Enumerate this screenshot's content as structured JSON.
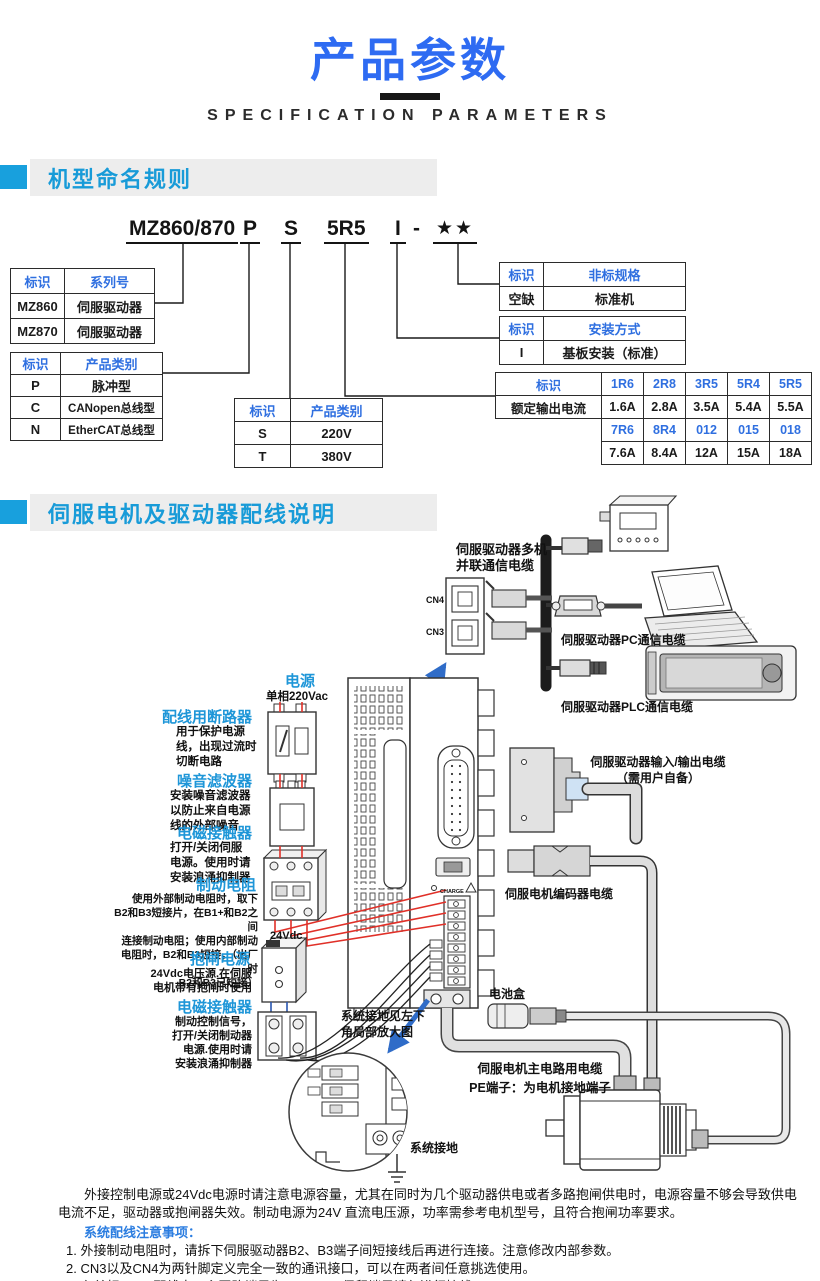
{
  "header": {
    "title": "产品参数",
    "subtitle": "SPECIFICATION PARAMETERS"
  },
  "naming": {
    "heading": "机型命名规则",
    "code": {
      "series": "MZ860/870",
      "product_type": "P",
      "voltage": "S",
      "current": "5R5",
      "mounting": "I",
      "separator": "-",
      "stars": "★★"
    },
    "series_table": {
      "headers": [
        "标识",
        "系列号"
      ],
      "rows": [
        [
          "MZ860",
          "伺服驱动器"
        ],
        [
          "MZ870",
          "伺服驱动器"
        ]
      ]
    },
    "product_type_table": {
      "headers": [
        "标识",
        "产品类别"
      ],
      "rows": [
        [
          "P",
          "脉冲型"
        ],
        [
          "C",
          "CANopen总线型"
        ],
        [
          "N",
          "EtherCAT总线型"
        ]
      ]
    },
    "voltage_table": {
      "headers": [
        "标识",
        "产品类别"
      ],
      "rows": [
        [
          "S",
          "220V"
        ],
        [
          "T",
          "380V"
        ]
      ]
    },
    "nonstandard_table": {
      "headers": [
        "标识",
        "非标规格"
      ],
      "rows": [
        [
          "空缺",
          "标准机"
        ]
      ]
    },
    "mounting_table": {
      "headers": [
        "标识",
        "安装方式"
      ],
      "rows": [
        [
          "I",
          "基板安装（标准）"
        ]
      ]
    },
    "current_table": {
      "header_label": "标识",
      "row_label": "额定输出电流",
      "codes_top": [
        "1R6",
        "2R8",
        "3R5",
        "5R4",
        "5R5"
      ],
      "amps_top": [
        "1.6A",
        "2.8A",
        "3.5A",
        "5.4A",
        "5.5A"
      ],
      "codes_bottom": [
        "7R6",
        "8R4",
        "012",
        "015",
        "018"
      ],
      "amps_bottom": [
        "7.6A",
        "8.4A",
        "12A",
        "15A",
        "18A"
      ]
    }
  },
  "wiring": {
    "heading": "伺服电机及驱动器配线说明",
    "power": {
      "title": "电源",
      "sub": "单相220Vac"
    },
    "breaker": {
      "title": "配线用断路器",
      "desc": "用于保护电源\n线，出现过流时\n切断电路"
    },
    "filter": {
      "title": "噪音滤波器",
      "desc": "安装噪音滤波器\n以防止来自电源\n线的外部噪音"
    },
    "contactor1": {
      "title": "电磁接触器",
      "desc": "打开/关闭伺服\n电源。使用时请\n安装浪涌抑制器"
    },
    "brake_resistor": {
      "title": "制动电阻",
      "desc": "使用外部制动电阻时，取下\nB2和B3短接片，在B1+和B2之间\n连接制动电阻；使用内部制动\n电阻时，B2和B3短接，（出厂时\nB2和B3已短接）"
    },
    "psu_24v": {
      "tag": "24Vdc",
      "title": "抱闸电源",
      "desc": "24Vdc电压源.在伺服\n电机带有抱闸时使用"
    },
    "contactor2": {
      "title": "电磁接触器",
      "desc": "制动控制信号，\n打开/关闭制动器\n电源.使用时请\n安装浪涌抑制器"
    },
    "multi_comm": "伺服驱动器多机\n并联通信电缆",
    "cn4": "CN4",
    "cn3": "CN3",
    "pc_cable": "伺服驱动器PC通信电缆",
    "plc_cable": "伺服驱动器PLC通信电缆",
    "io_cable": "伺服驱动器输入/输出电缆\n（需用户自备）",
    "encoder_cable": "伺服电机编码器电缆",
    "battery": "电池盒",
    "ground_note": "系统接地见左下\n角局部放大图",
    "motor_cable": "伺服电机主电路用电缆\nPE端子：为电机接地端子",
    "system_ground": "系统接地",
    "charge": "CHARGE"
  },
  "notes": {
    "paragraph": "外接控制电源或24Vdc电源时请注意电源容量，尤其在同时为几个驱动器供电或者多路抱闸供电时，电源容量不够会导致供电电流不足，驱动器或抱闸器失效。制动电源为24V 直流电压源，功率需参考电机型号，且符合抱闸功率要求。",
    "heading": "系统配线注意事项：",
    "items": [
      "1. 外接制动电阻时，请拆下伺服驱动器B2、B3端子间短接线后再进行连接。注意修改内部参数。",
      "2. CN3以及CN4为两针脚定义完全一致的通讯接口，可以在两者间任意挑选使用。",
      "3. 在单相220V 配线中，主回路端子为 L1、L2，保留端子请勿进行接线。"
    ]
  },
  "colors": {
    "title_blue": "#2e6bf2",
    "sky_blue": "#1e96d8",
    "table_blue": "#2f6fe0",
    "wire_red": "#e03028",
    "arrow_blue": "#2f6cc8"
  }
}
